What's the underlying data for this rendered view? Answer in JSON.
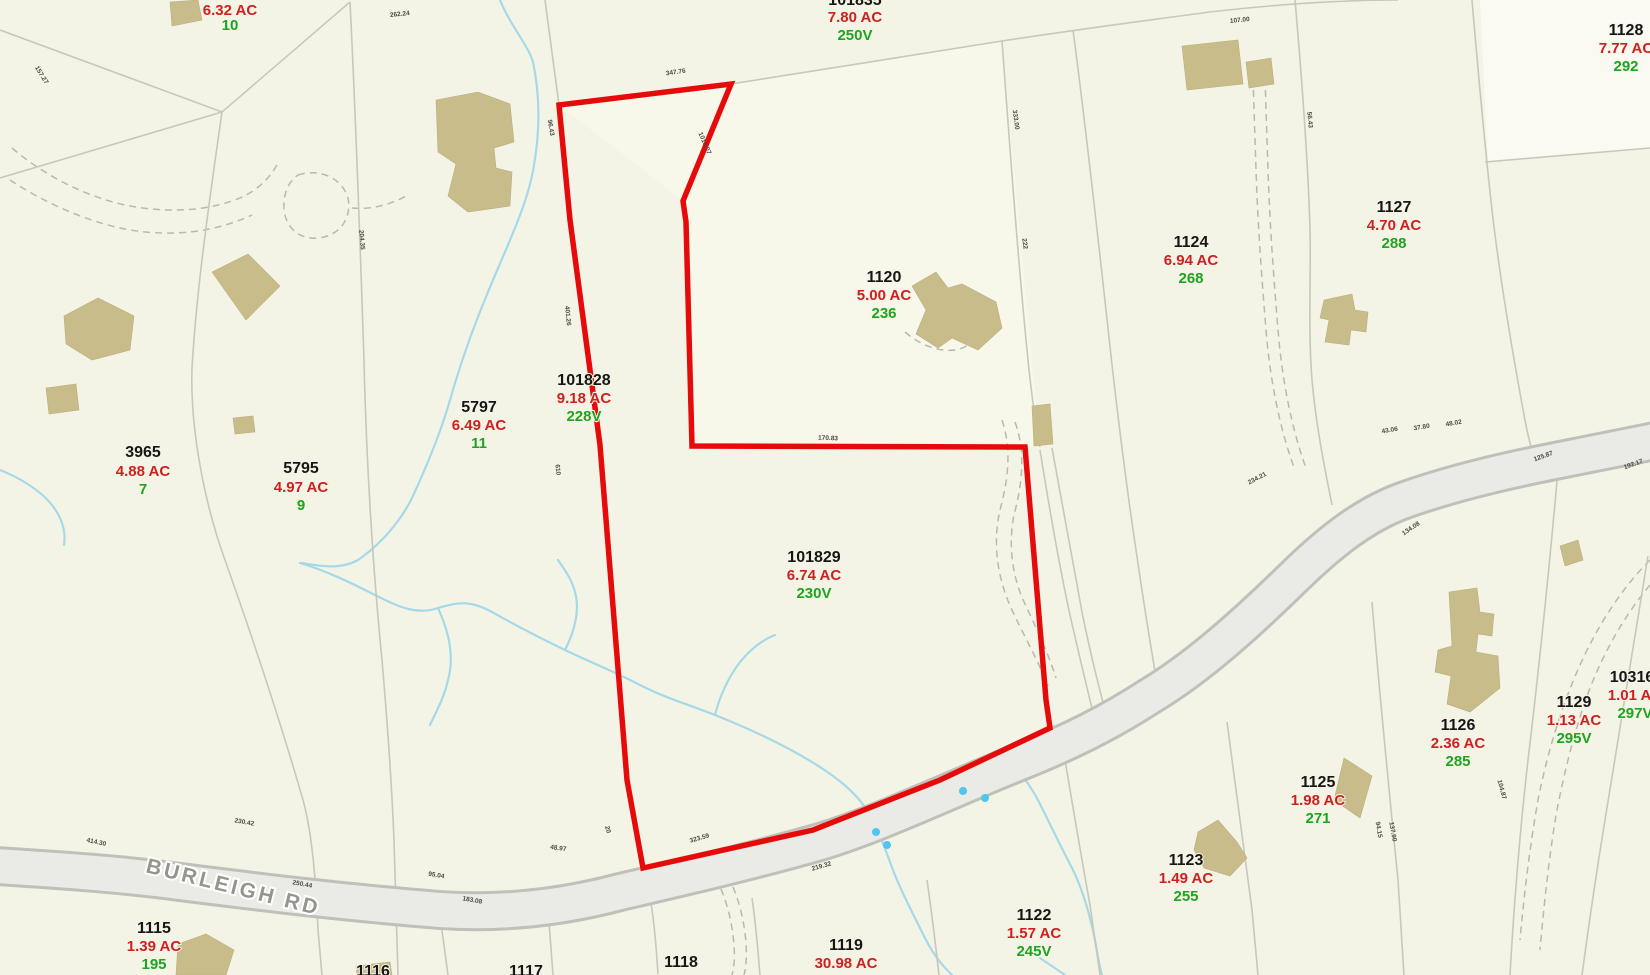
{
  "map_type": "parcel-tax-map",
  "road": {
    "name": "BURLEIGH RD"
  },
  "highlighted_parcel": {
    "id": "101829",
    "area": "6.74 AC",
    "value": "230V",
    "outline_color": "#e60b0b"
  },
  "colors": {
    "background": "#f4f4e6",
    "parcel_line": "#c7c7ba",
    "road_fill": "#eaeae6",
    "road_edge": "#c0c0ba",
    "building": "#c9bc8b",
    "stream": "#a6d9e8",
    "parcel_id_text": "#161616",
    "acreage_text": "#cf2020",
    "value_text": "#1fa41f"
  },
  "parcels": [
    {
      "id": "",
      "area": "6.32 AC",
      "value": "10"
    },
    {
      "id": "101835",
      "area": "7.80 AC",
      "value": "250V"
    },
    {
      "id": "3965",
      "area": "4.88 AC",
      "value": "7"
    },
    {
      "id": "5795",
      "area": "4.97 AC",
      "value": "9"
    },
    {
      "id": "5797",
      "area": "6.49 AC",
      "value": "11"
    },
    {
      "id": "101828",
      "area": "9.18 AC",
      "value": "228V"
    },
    {
      "id": "101829",
      "area": "6.74 AC",
      "value": "230V"
    },
    {
      "id": "1120",
      "area": "5.00 AC",
      "value": "236"
    },
    {
      "id": "1124",
      "area": "6.94 AC",
      "value": "268"
    },
    {
      "id": "1127",
      "area": "4.70 AC",
      "value": "288"
    },
    {
      "id": "1128",
      "area": "7.77 AC",
      "value": "292"
    },
    {
      "id": "1126",
      "area": "2.36 AC",
      "value": "285"
    },
    {
      "id": "1129",
      "area": "1.13 AC",
      "value": "295V"
    },
    {
      "id": "10316",
      "area": "1.01 AC",
      "value": "297V"
    },
    {
      "id": "1125",
      "area": "1.98 AC",
      "value": "271"
    },
    {
      "id": "1123",
      "area": "1.49 AC",
      "value": "255"
    },
    {
      "id": "1122",
      "area": "1.57 AC",
      "value": "245V"
    },
    {
      "id": "1119",
      "area": "30.98 AC",
      "value": ""
    },
    {
      "id": "1118",
      "area": "25,000 SF",
      "value": ""
    },
    {
      "id": "1117",
      "area": "",
      "value": ""
    },
    {
      "id": "1116",
      "area": "",
      "value": ""
    },
    {
      "id": "1115",
      "area": "1.39 AC",
      "value": "195"
    }
  ],
  "dimensions": [
    {
      "t": "262.24"
    },
    {
      "t": "157.27"
    },
    {
      "t": "347.76"
    },
    {
      "t": "96.43"
    },
    {
      "t": "1013.07"
    },
    {
      "t": "401.26"
    },
    {
      "t": "610"
    },
    {
      "t": "170.83"
    },
    {
      "t": "333.00"
    },
    {
      "t": "222"
    },
    {
      "t": "107.00"
    },
    {
      "t": "43.06"
    },
    {
      "t": "37.80"
    },
    {
      "t": "48.02"
    },
    {
      "t": "125.87"
    },
    {
      "t": "192.17"
    },
    {
      "t": "134.08"
    },
    {
      "t": "94.15"
    },
    {
      "t": "137.90"
    },
    {
      "t": "414.30"
    },
    {
      "t": "230.42"
    },
    {
      "t": "250.44"
    },
    {
      "t": "95.04"
    },
    {
      "t": "183.08"
    },
    {
      "t": "48.97"
    },
    {
      "t": "20"
    },
    {
      "t": "323.59"
    },
    {
      "t": "219.32"
    },
    {
      "t": "234.21"
    },
    {
      "t": "204.35"
    },
    {
      "t": "56.43"
    },
    {
      "t": "104.87"
    }
  ]
}
